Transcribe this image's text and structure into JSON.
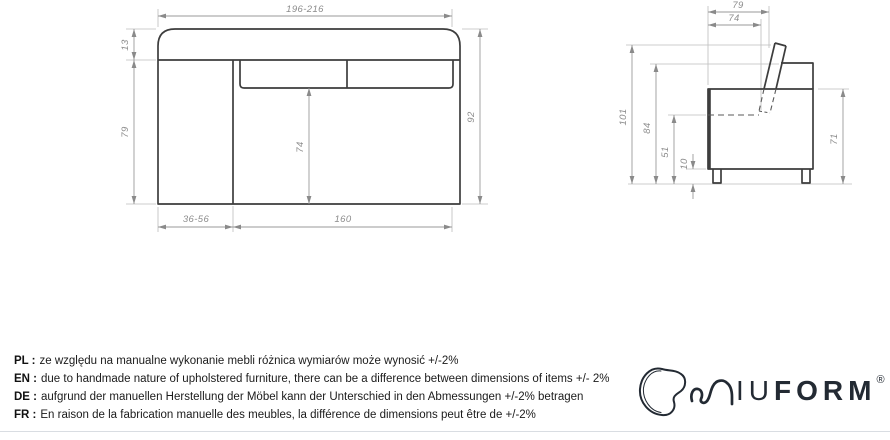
{
  "front_view": {
    "width": "196-216",
    "backrest_top": "13",
    "side_height": "79",
    "total_height": "92",
    "seat_front_height": "74",
    "armrest_width": "36-56",
    "seat_width": "160"
  },
  "side_view": {
    "depth": "79",
    "seat_depth": "74",
    "total_height": "101",
    "backrest_height": "84",
    "seat_level_height": "51",
    "leg_height": "10",
    "arm_height": "71"
  },
  "disclaimer": [
    {
      "label": "PL :",
      "text": "ze względu na manualne wykonanie mebli różnica wymiarów może wynosić +/-2%"
    },
    {
      "label": "EN :",
      "text": "due to handmade nature of upholstered furniture, there can be a difference between dimensions of items +/- 2%"
    },
    {
      "label": "DE :",
      "text": "aufgrund der manuellen Herstellung der Möbel kann der Unterschied in den Abmessungen +/-2% betragen"
    },
    {
      "label": "FR :",
      "text": "En raison de la fabrication manuelle des meubles, la différence de dimensions peut être de +/-2%"
    }
  ],
  "logo": {
    "name_light": "IU",
    "name_bold": "FORM",
    "registered": "®"
  },
  "colors": {
    "outline": "#3d3d3d",
    "dimension_lines": "#9a9a9a",
    "dimension_text": "#8c8c8c",
    "logo": "#232a33",
    "divider": "#d9dde2"
  }
}
